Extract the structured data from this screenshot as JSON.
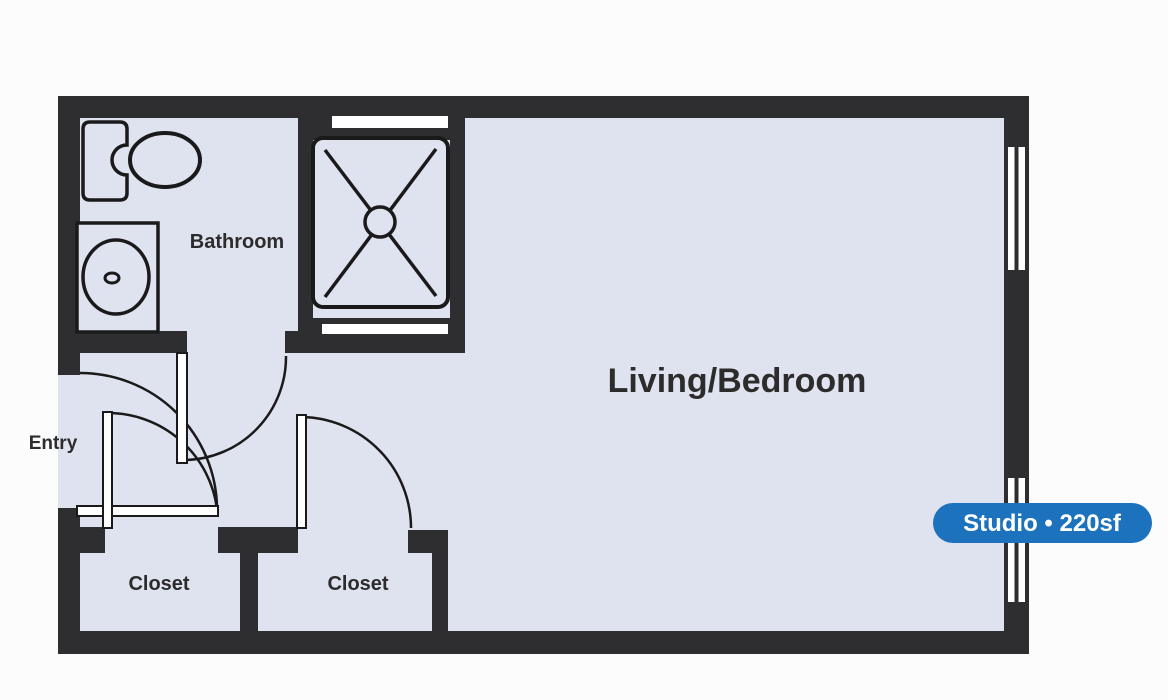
{
  "floor_plan": {
    "rooms": {
      "bathroom": "Bathroom",
      "living_bedroom": "Living/Bedroom",
      "entry": "Entry",
      "closet_left": "Closet",
      "closet_right": "Closet"
    },
    "badge": {
      "label": "Studio • 220sf",
      "bg_color": "#1c72bd",
      "text_color": "#ffffff"
    },
    "icons": [
      "toilet-icon",
      "sink-icon",
      "shower-icon",
      "window-icon",
      "door-swing-icon"
    ],
    "colors": {
      "wall": "#2e2e30",
      "floor": "#dfe3ef",
      "outline": "#1a1a1a",
      "background": "#fcfcfc"
    }
  }
}
